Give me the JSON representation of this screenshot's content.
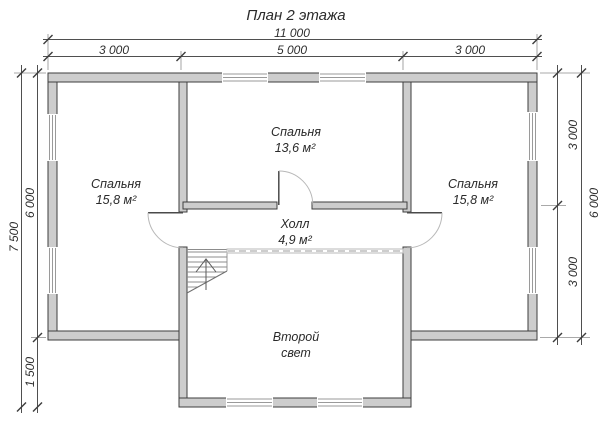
{
  "title": "План 2 этажа",
  "dims": {
    "top_total": "11 000",
    "top_seg_left": "3 000",
    "top_seg_center": "5 000",
    "top_seg_right": "3 000",
    "left_total": "7 500",
    "left_seg_upper": "6 000",
    "left_seg_lower": "1 500",
    "right_seg_upper": "3 000",
    "right_seg_lower": "3 000",
    "right_total": "6 000"
  },
  "rooms": {
    "bedroom_left": {
      "name": "Спальня",
      "area": "15,8 м²"
    },
    "bedroom_center": {
      "name": "Спальня",
      "area": "13,6 м²"
    },
    "bedroom_right": {
      "name": "Спальня",
      "area": "15,8 м²"
    },
    "hall": {
      "name": "Холл",
      "area": "4,9 м²"
    },
    "second_light": {
      "name_line1": "Второй",
      "name_line2": "свет"
    }
  },
  "icons": {
    "stairs": "stairs-up-arrow-icon"
  },
  "colors": {
    "wall_fill": "#cdcdcd",
    "wall_stroke": "#3e3e3e",
    "dimension_line": "#4f4f4f",
    "text": "#2a2a2a",
    "door_arc": "#b8b8b8",
    "background": "#ffffff"
  }
}
